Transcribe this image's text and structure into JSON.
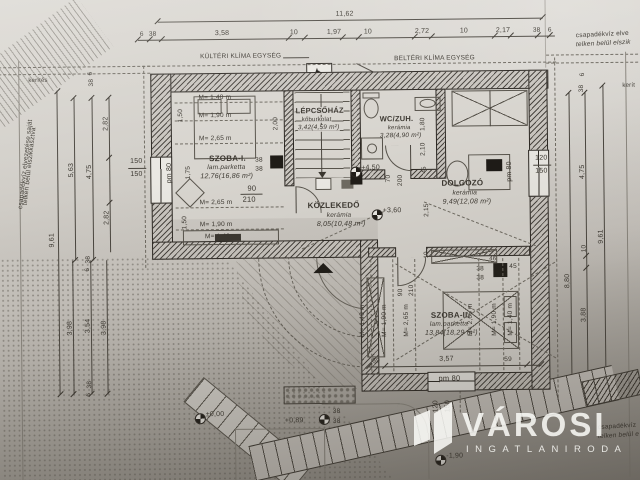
{
  "logo": {
    "brand": "VÁROSI",
    "subtitle": "INGATLANIRODA"
  },
  "rooms": {
    "szoba1": {
      "name": "SZOBA-I.",
      "material": "lam.parketta",
      "area": "12,76(16,86 m²)"
    },
    "lepcsohaz": {
      "name": "LÉPCSŐHÁZ",
      "material": "kőburkolat",
      "area": "3,42(4,59 m²)"
    },
    "wc": {
      "name": "WC/ZUH.",
      "material": "kerámia",
      "area": "3,28(4,90 m²)"
    },
    "kozlekedo": {
      "name": "KÖZLEKEDŐ",
      "material": "kerámia",
      "area": "8,05(10,48 m²)"
    },
    "dolgozo": {
      "name": "DOLGOZÓ",
      "material": "kerámia",
      "area": "9,49(12,08 m²)"
    },
    "szoba2": {
      "name": "SZOBA-II.",
      "material": "lam.parketta",
      "area": "13,84(18,29 m²)"
    }
  },
  "levels": {
    "p450": "+4,50",
    "p360": "+3,60",
    "zero": "±0,00",
    "p089": "+0,89",
    "m190": "-1,90"
  },
  "site": {
    "kulteri": "KÜLTÉRI KLÍMA EGYSÉG",
    "belteri": "BELTÉRI KLÍMA EGYSÉG",
    "kerites_left": "kerítés",
    "kerites_right": "kerít",
    "drain_left1": "csapadékvíz elvezetése saját",
    "drain_left2": "telken belül elszikkasztva",
    "drain_right1": "csapadékvíz elve",
    "drain_right2": "telken belül elszik",
    "drain_br1": "csapadékvíz",
    "drain_br2": "telken belül e"
  },
  "dims": {
    "topTotal": "11,62",
    "t6a": "6",
    "t38a": "38",
    "t358": "3,58",
    "t10a": "10",
    "t197": "1,97",
    "t10b": "10",
    "t272": "2,72",
    "t10c": "10",
    "t217": "2,17",
    "t38b": "38",
    "t6b": "6",
    "l961": "9,61",
    "l563": "5,63",
    "l475": "4,75",
    "l282a": "2,82",
    "l282b": "2,82",
    "l38a": "38",
    "l6a": "6",
    "l398a": "3,98",
    "l354": "3,54",
    "l398b": "3,98",
    "l38b": "38",
    "l6b": "6",
    "l38c": "38",
    "l6c": "6",
    "r961": "9,61",
    "r880": "8,80",
    "r475": "4,75",
    "r10": "10",
    "r388": "3,88",
    "r38a": "38",
    "r6a": "6",
    "r38b": "38",
    "winL1": "150",
    "winL2": "150",
    "winR1": "120",
    "winR2": "150",
    "winB1": "120",
    "winB2": "150",
    "pm80L": "pm 80",
    "pm80R": "pm 80",
    "pm80B": "pm 80",
    "door1w": "90",
    "door1h": "210",
    "door2w": "70",
    "door2h": "200",
    "door3w": "90",
    "door3h": "210",
    "h140a": "M= 1,40 m",
    "h190a": "M= 1,90 m",
    "h265a": "M= 2,65 m",
    "h265b": "M= 2,65 m",
    "h190b": "M= 1,90 m",
    "h140c": "M= 1,40 m",
    "h140d": "M= 1,40 m",
    "h190c": "M= 1,90 m",
    "h265c": "M= 2,65 m",
    "h265d": "M= 2,65 m",
    "h190d": "M= 1,90 m",
    "h140e": "M= 1,40 m",
    "s150a": "1,50",
    "s175": "1,75",
    "s150b": "1,50",
    "s200": "2,00",
    "s180": "1,80",
    "s210": "2,10",
    "s215": "2,15",
    "s45a": "45",
    "s45b": "45",
    "s10": "10",
    "s46": "46",
    "c38a": "38",
    "c38b": "38",
    "c38c": "38",
    "c38d": "38",
    "c38e": "38",
    "c38f": "38",
    "b59a": "59",
    "b357": "3,57",
    "b59b": "59"
  }
}
